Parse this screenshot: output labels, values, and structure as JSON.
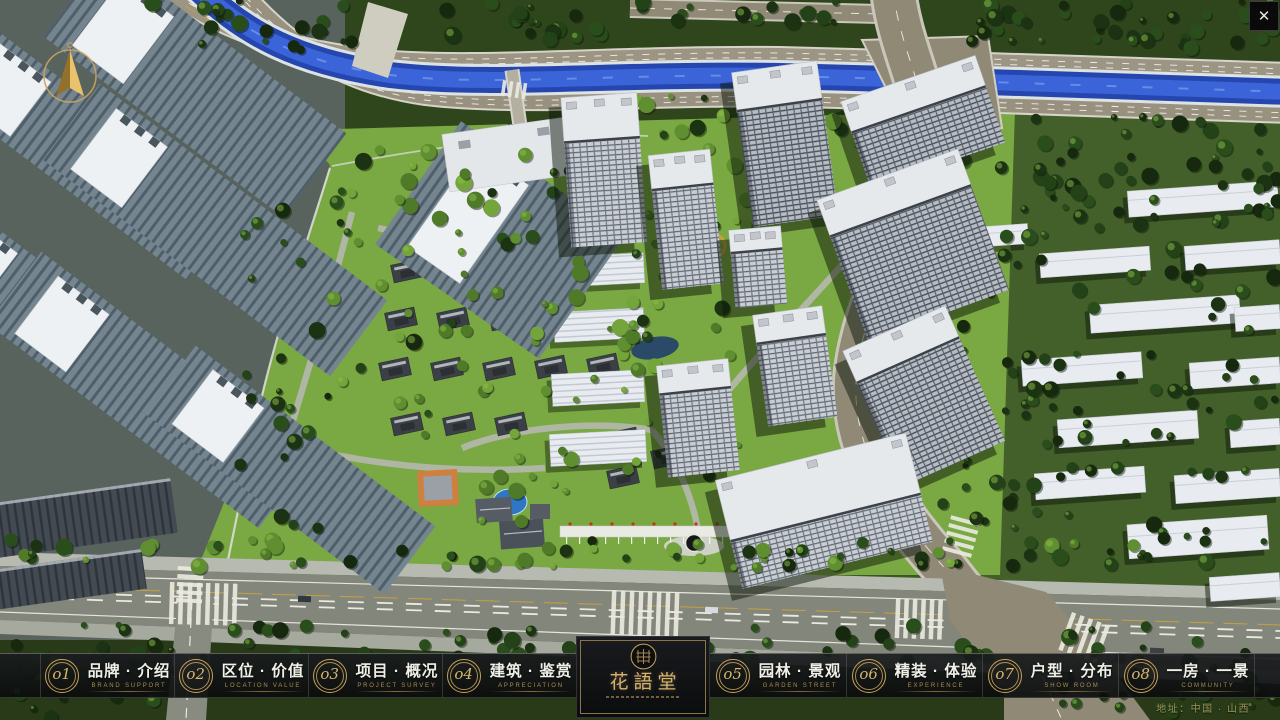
{
  "nav": {
    "items": [
      {
        "number": "o1",
        "label": "品牌 · 介绍",
        "sublabel": "BRAND SUPPORT"
      },
      {
        "number": "o2",
        "label": "区位 · 价值",
        "sublabel": "LOCATION VALUE"
      },
      {
        "number": "o3",
        "label": "项目 · 概况",
        "sublabel": "PROJECT SURVEY"
      },
      {
        "number": "o4",
        "label": "建筑 · 鉴赏",
        "sublabel": "APPRECIATION"
      },
      {
        "number": "o5",
        "label": "园林 · 景观",
        "sublabel": "GARDEN STREET"
      },
      {
        "number": "o6",
        "label": "精装 · 体验",
        "sublabel": "EXPERIENCE"
      },
      {
        "number": "o7",
        "label": "户型 · 分布",
        "sublabel": "SHOW ROOM"
      },
      {
        "number": "o8",
        "label": "一房 · 一景",
        "sublabel": "COMMUNITY"
      }
    ]
  },
  "logo": {
    "name": "花語堂"
  },
  "footer": {
    "address": "地址：中国 · 山西"
  },
  "window": {
    "close_glyph": "✕"
  },
  "colors": {
    "gold": "#c9a25c",
    "bar_bg": "#0b0d0e",
    "river": "#2b50bd",
    "grass": "#7aa843"
  }
}
